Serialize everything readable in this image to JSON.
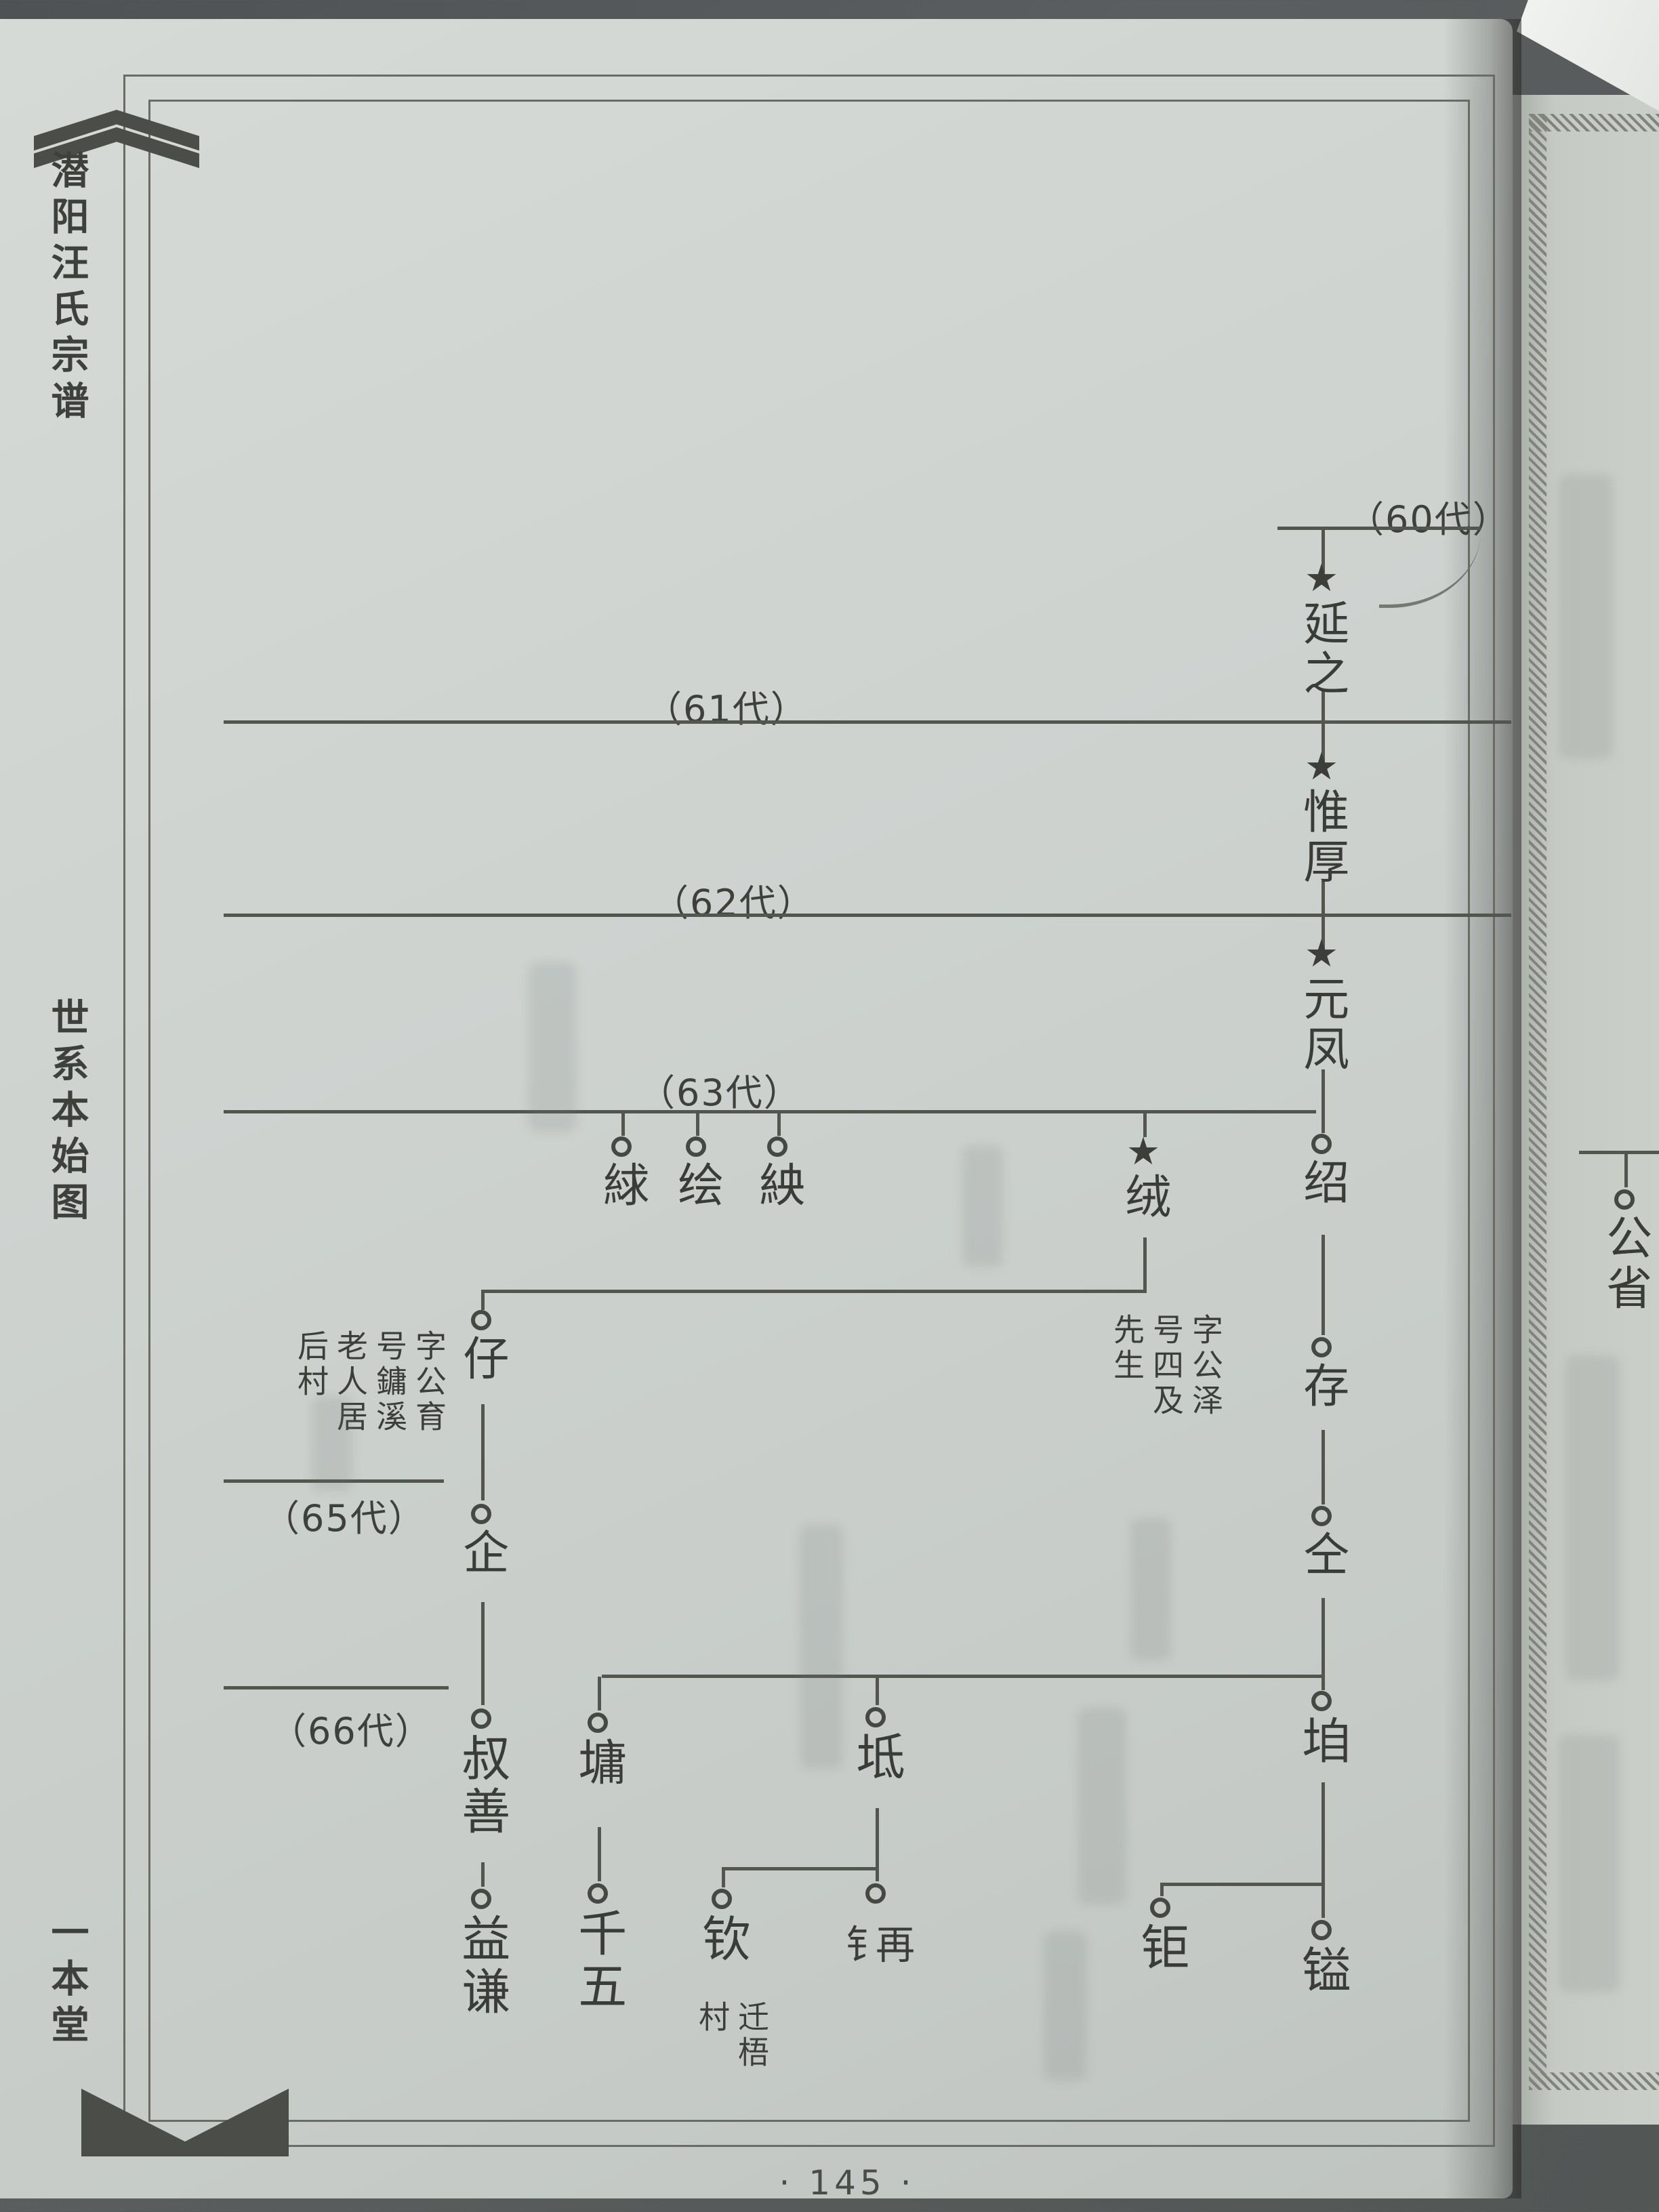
{
  "icons": {
    "star": "★"
  },
  "margin": {
    "title_top": "潜阳汪氏宗谱",
    "title_middle": "世系本始图",
    "title_bottom": "一本堂"
  },
  "generations": [
    {
      "label": "（60代）"
    },
    {
      "label": "（61代）"
    },
    {
      "label": "（62代）"
    },
    {
      "label": "（63代）"
    },
    {
      "label": "（65代）"
    },
    {
      "label": "（66代）"
    }
  ],
  "tree": {
    "nodes": [
      {
        "name": "延之",
        "marker": "star"
      },
      {
        "name": "惟厚",
        "marker": "star"
      },
      {
        "name": "元凤",
        "marker": "star"
      },
      {
        "name": "绍",
        "marker": "circle"
      },
      {
        "name": "絿",
        "marker": "circle"
      },
      {
        "name": "绘",
        "marker": "circle"
      },
      {
        "name": "紻",
        "marker": "circle"
      },
      {
        "name": "绒",
        "marker": "star",
        "annotation": "字公泽号四及先生"
      },
      {
        "name": "存",
        "marker": "circle"
      },
      {
        "name": "仔",
        "marker": "circle",
        "annotation": "字公育号鏞溪老人居后村"
      },
      {
        "name": "仝",
        "marker": "circle"
      },
      {
        "name": "企",
        "marker": "circle"
      },
      {
        "name": "叔善",
        "marker": "circle"
      },
      {
        "name": "墉",
        "marker": "circle"
      },
      {
        "name": "坻",
        "marker": "circle"
      },
      {
        "name": "垍",
        "marker": "circle"
      },
      {
        "name": "益谦",
        "marker": "circle"
      },
      {
        "name": "千五",
        "marker": "circle"
      },
      {
        "name": "钦",
        "marker": "circle",
        "annotation": "迁梧村"
      },
      {
        "name": "钅再",
        "marker": "circle"
      },
      {
        "name": "钜",
        "marker": "circle"
      },
      {
        "name": "镒",
        "marker": "circle"
      },
      {
        "name": "公省",
        "marker": "circle"
      }
    ]
  },
  "footer": {
    "page_number": "· 145 ·"
  }
}
